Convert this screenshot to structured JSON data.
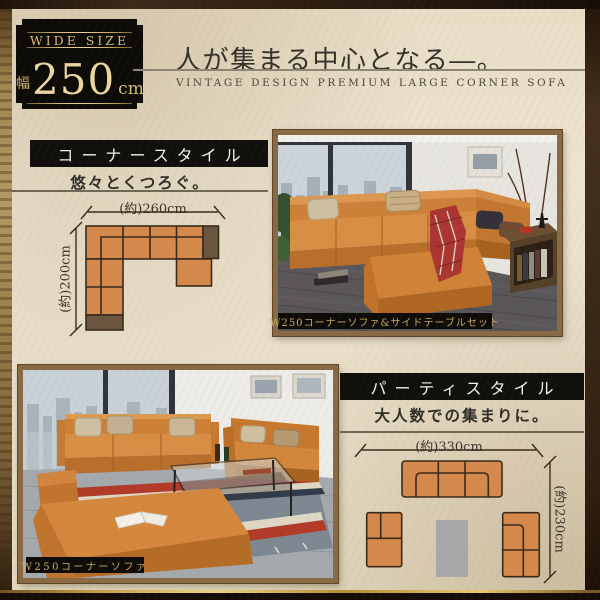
{
  "badge": {
    "label": "WIDE SIZE",
    "width_prefix": "幅",
    "width_value": "250",
    "width_unit": "cm"
  },
  "header": {
    "title": "人が集まる中心となる―。",
    "subtitle": "VINTAGE DESIGN PREMIUM LARGE CORNER SOFA"
  },
  "corner_style": {
    "heading": "コーナースタイル",
    "tagline": "悠々とくつろぐ。",
    "width_label": "(約)260cm",
    "depth_label": "(約)200cm"
  },
  "party_style": {
    "heading": "パーティスタイル",
    "tagline": "大人数での集まりに。",
    "width_label": "(約)330cm",
    "depth_label": "(約)230cm"
  },
  "photos": {
    "corner_set_caption": "W250コーナーソファ&サイドテーブルセット",
    "sofa_caption": "W250コーナーソファ"
  },
  "colors": {
    "accent_gold": "#d6b878",
    "sofa_orange": "#d5894c",
    "corner_brown": "#6a553f",
    "table_gray": "#a7a9aa",
    "paper": "#eae0ca",
    "frame_brown": "#8a6a45",
    "bar_black": "#100f0c"
  }
}
